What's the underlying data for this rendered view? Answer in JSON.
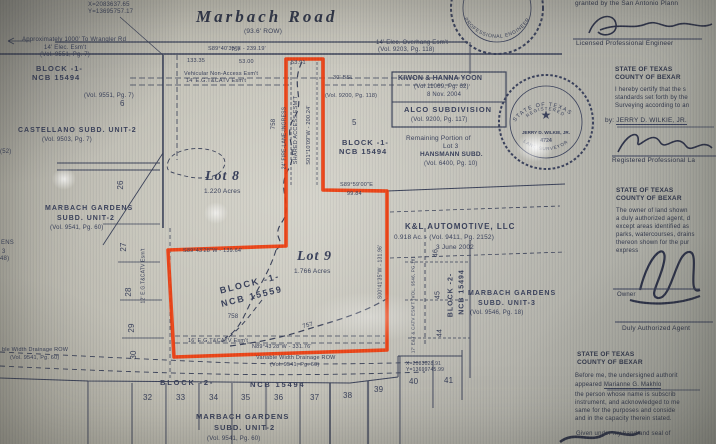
{
  "road": {
    "name": "Marbach Road",
    "row": "(93.6' ROW)",
    "bearing": "S89°40'35\"E - 239.19'",
    "dim_a": "133.35",
    "dim_b": "53.00",
    "contour": "757"
  },
  "coords": {
    "top_x": "X=2083637.65",
    "top_y": "Y=13695757.17",
    "bottom_x": "X=2083028.91",
    "bottom_y": "Y=13699745.99"
  },
  "notes": {
    "wrangler": "Approximately 1000' To Wrangler Rd",
    "elec_esmt": "14' Elec. Esm't",
    "elec_esmt_vol": "(Vol. 9551, Pg. 7)",
    "vna": "Vehicular Non-Access Esm't",
    "egtcatv14": "14' E.G.T&CATV Esm't",
    "overhang": "14' Elec. Overhang Esm't",
    "overhang_vol": "(Vol. 9203, Pg. 118)",
    "vol9200": "(Vol. 9200, Pg. 118)",
    "bsl": "30' BSL",
    "stem_dim": "53.91",
    "shared_access": "SHARED ACCESS ESM'T",
    "stem_bearing": "S01°10'09\"W - 200.24'",
    "fire_lane": "24' FIRE-LANE-INGRESS",
    "notch_bearing": "S89°59'00\"E",
    "notch_dim": "99.84",
    "mid_bearing": "S89°43'28\"W - 139.64'",
    "bottom_bearing": "N89°43'28\"W - 331.76'",
    "right_bearing": "S00°41'35\"W - 131.96'",
    "esmt12": "12' E.G.T&CATV Esm't",
    "egtcatv16": "16' E.G.T&CATV Esm't",
    "drainage": "Variable Width Drainage ROW",
    "drainage_vol": "(Vol. 9541, Pg. 60)",
    "drainage_left": "ble Width Drainage ROW",
    "drainage_left_vol": "(Vol. 9541, Pg. 60)",
    "catv17": "17' E&T & CATV ESM'T (VOL. 9546, PG.18)"
  },
  "parcels": {
    "lot8": {
      "name": "Lot 8",
      "acres": "1.220 Acres"
    },
    "lot9": {
      "name": "Lot 9",
      "acres": "1.766 Acres"
    },
    "block1_center": {
      "l1": "BLOCK -1-",
      "l2": "NCB 15559"
    },
    "block1_left": {
      "l1": "BLOCK -1-",
      "l2": "NCB 15494",
      "vol": "(Vol. 9551, Pg. 7)",
      "lot": "6"
    },
    "block1_right": {
      "l1": "BLOCK -1-",
      "l2": "NCB 15494"
    },
    "remaining": {
      "l1": "Remaining Portion of",
      "l2": "Lot 3",
      "l3": "HANSMANN SUBD.",
      "l4": "(Vol. 6400, Pg. 10)"
    },
    "yoon": {
      "l1": "KIWON & HANNA YOON",
      "l2": "(Vol 11069, Pg. 62)",
      "l3": "8 Nov. 2004"
    },
    "alco": {
      "l1": "ALCO SUBDIVISION",
      "l2": "(Vol. 9200, Pg. 117)"
    },
    "kl": {
      "l1": "K&L AUTOMOTIVE, LLC",
      "l2": "0.918 Ac. - (Vol. 9411, Pg. 2152)",
      "l3": "3 June 2002"
    },
    "castellano": {
      "l1": "CASTELLANO SUBD. UNIT-2",
      "l2": "(Vol. 9503, Pg. 7)"
    },
    "mg2_left": {
      "l1": "MARBACH GARDENS",
      "l2": "SUBD. UNIT-2",
      "l3": "(Vol. 9541, Pg. 60)"
    },
    "mg2_bottom": {
      "l1": "MARBACH GARDENS",
      "l2": "SUBD. UNIT-2",
      "l3": "(Vol. 9541, Pg. 60)"
    },
    "mg3": {
      "l1": "MARBACH GARDENS",
      "l2": "SUBD. UNIT-3",
      "l3": "(Vol. 9546, Pg. 18)"
    },
    "block2_bottom": {
      "l1": "BLOCK -2-",
      "l2": "NCB 15494"
    },
    "block2_right": {
      "l1": "BLOCK -2-",
      "l2": "NCB 15494"
    },
    "lot5": "5"
  },
  "lot_numbers": {
    "left": [
      "26",
      "27",
      "28",
      "29",
      "30"
    ],
    "bottom": [
      "32",
      "33",
      "34",
      "35",
      "36",
      "37",
      "38",
      "39",
      "40",
      "41"
    ],
    "right": [
      "46",
      "45",
      "44"
    ]
  },
  "contours": {
    "c758a": "758",
    "c758b": "758",
    "c757": "757"
  },
  "edge_fragments": {
    "f1": "(52)",
    "f2": "ENS",
    "f3": "3",
    "f4": "48)"
  },
  "panel": {
    "granted": "granted by the San Antonio Plann",
    "lpe": "Licensed Professional Engineer",
    "state": "STATE OF TEXAS",
    "county": "COUNTY OF BEXAR",
    "cert1": "I hereby certify that the s",
    "cert2": "standards set forth by the",
    "cert3": "Surveying according to an",
    "by": "by:",
    "wilkie": "JERRY D. WILKIE, JR.",
    "rpls": "Registered Professional La",
    "own1": "The owner of land shown",
    "own2": "a duly authorized agent, d",
    "own3": "except areas identified as",
    "own4": "parks, watercourses, drains",
    "own5": "thereon shown for the pur",
    "own6": "express",
    "owner": "Owner",
    "daa": "Duly Authorized Agent",
    "not1": "Before me, the undersigned authorit",
    "not2": "appeared",
    "not2name": "Marianne G. Makhlo",
    "not3": "the person whose name is subscrib",
    "not4": "instrument, and acknowledged to me",
    "not5": "same for the purposes and conside",
    "not6": "and in the capacity therein stated.",
    "given": "Given under my hand and seal of"
  },
  "seals": {
    "surveyor_top": "STATE OF TEXAS",
    "surveyor_mid": "REGISTERED",
    "surveyor_name": "JERRY D. WILKIE, JR.",
    "surveyor_no": "4724",
    "surveyor_bottom": "LAND SURVEYOR",
    "engineer_top": "REGISTERED",
    "engineer_bottom": "PROFESSIONAL ENGINEER",
    "star": "★"
  },
  "colors": {
    "boundary": "#ee3b0c",
    "ink": "#39405a",
    "paper": "#bcb9ad"
  }
}
